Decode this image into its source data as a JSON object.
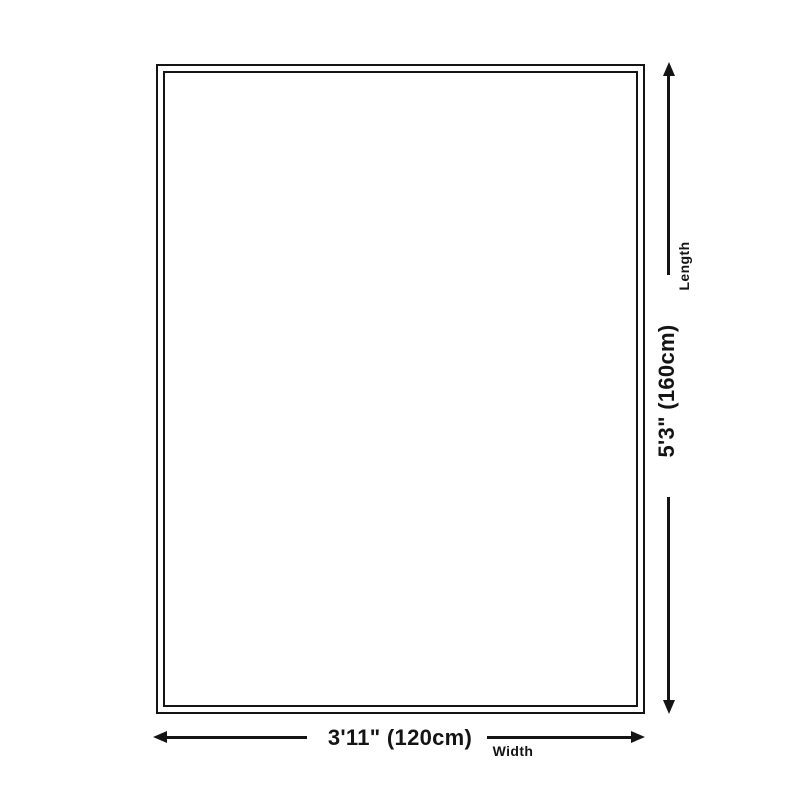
{
  "diagram": {
    "type": "product-size-diagram",
    "background_color": "#ffffff",
    "line_color": "#141414",
    "dimensions": {
      "length": {
        "label": "Length",
        "value": "5'3\" (160cm)"
      },
      "width": {
        "label": "Width",
        "value": "3'11\" (120cm)"
      }
    }
  }
}
